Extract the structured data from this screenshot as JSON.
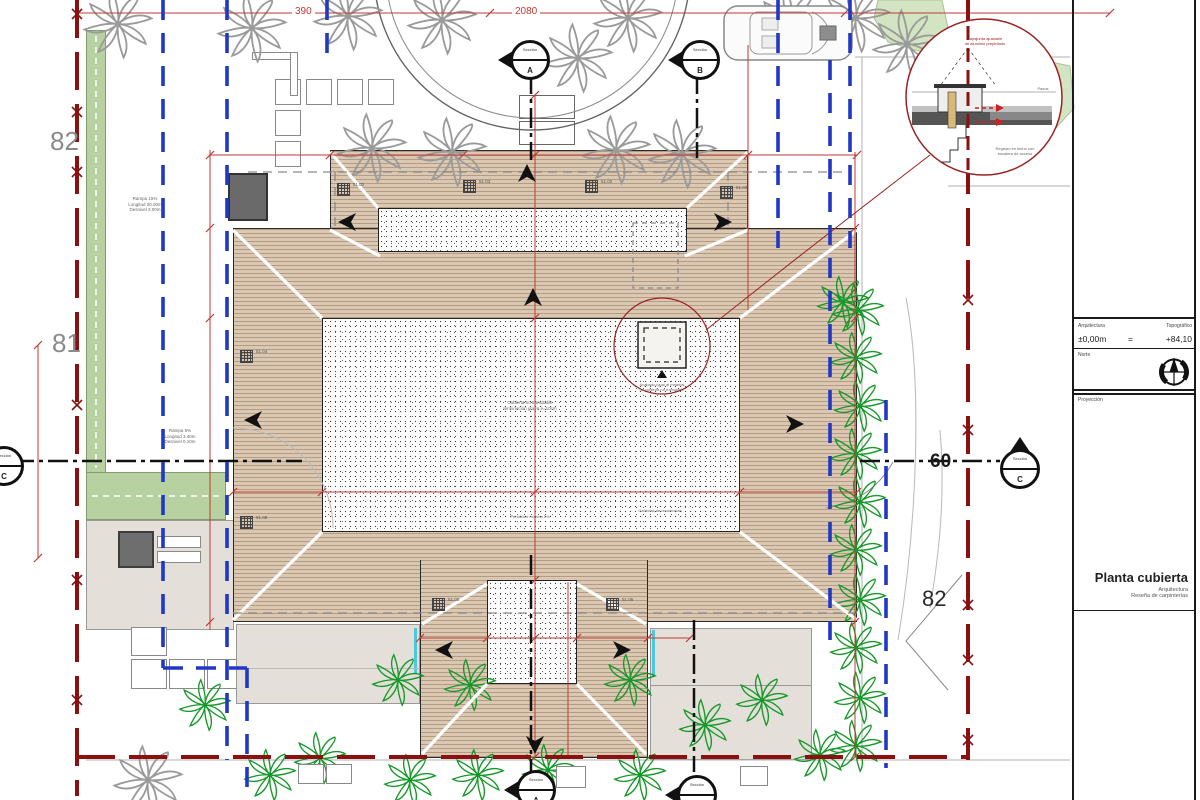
{
  "labels": {
    "dim_390": "390",
    "dim_2080": "2080",
    "contour_82_left": "82",
    "contour_81_left": "81",
    "contour_60_right": "60",
    "contour_82_right": "82"
  },
  "sections": {
    "word": "Sección",
    "a": "A",
    "b": "B",
    "c": "C"
  },
  "drain_levels": [
    "51.02",
    "51.03",
    "51.02",
    "51.03",
    "51.04",
    "51.08",
    "51.05",
    "51.06"
  ],
  "notes": {
    "ramp_upper": [
      "Rampa 15%",
      "Longitud 20.00m",
      "Desnivel 3.00m"
    ],
    "ramp_lower": [
      "Rampa 5%",
      "Longitud 3.40m",
      "Desnivel 0.10m"
    ],
    "roof_center": [
      "Cubierta no transitable",
      "terminación grava e=10cm"
    ],
    "roof_note_sw": "Pendiente mínima 2%",
    "roof_note_se": "Cañerías de recolección",
    "skylight": [
      "Acabado igual al material",
      "de cubierta no transitable"
    ],
    "detail_top": [
      "Tapajunta ajustable",
      "de aluminio prepintado"
    ],
    "detail_pasos": "Pasos",
    "detail_registro": [
      "Registro en techo con",
      "escalera de acceso"
    ]
  },
  "title_block": {
    "arch_label": "Arquitectura",
    "topo_label": "Topográfico",
    "arch_value": "±0,00m",
    "equals": "=",
    "topo_value": "+84,10",
    "north_label": "Norte",
    "projection_label": "Proyección",
    "title": "Planta cubierta",
    "subtitle1": "Arquitectura",
    "subtitle2": "Reseña de carpinterías"
  },
  "colors": {
    "property_line": "#8b1111",
    "setback_line": "#2038c4",
    "dimension_line": "#c03a32",
    "roof_hatch": "#dac8b2",
    "green_strip": "#b7d2a0",
    "palm_green": "#17982a",
    "palm_gray": "#9a9a9a"
  }
}
